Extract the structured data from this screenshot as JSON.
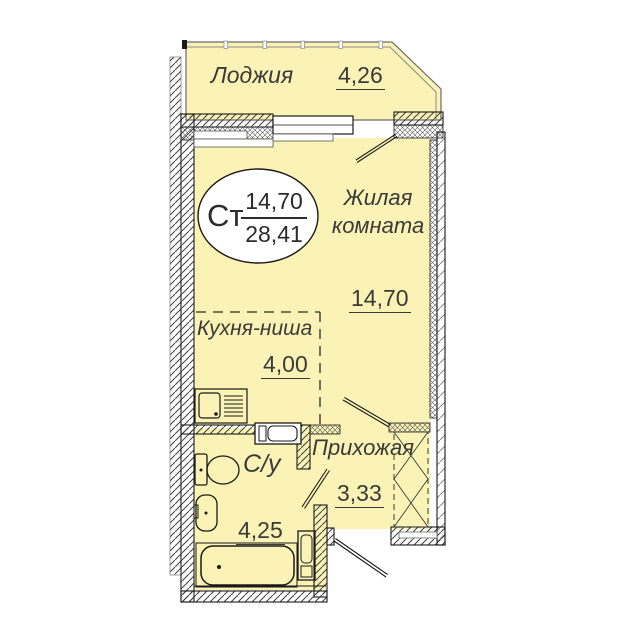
{
  "plan": {
    "loggia": {
      "label": "Лоджия",
      "area": "4,26"
    },
    "living_room": {
      "label_line1": "Жилая",
      "label_line2": "комната",
      "area": "14,70"
    },
    "kitchen_niche": {
      "label": "Кухня-ниша",
      "area": "4,00"
    },
    "hallway": {
      "label": "Прихожая",
      "area": "3,33"
    },
    "bathroom": {
      "label": "С/у",
      "area": "4,25"
    },
    "stamp": {
      "apartment_type": "Ст",
      "living_area": "14,70",
      "total_area": "28,41"
    },
    "colors": {
      "room_fill": "#FAF3B5",
      "wall_line": "#1A1A1A",
      "text": "#3A3A3A"
    }
  }
}
